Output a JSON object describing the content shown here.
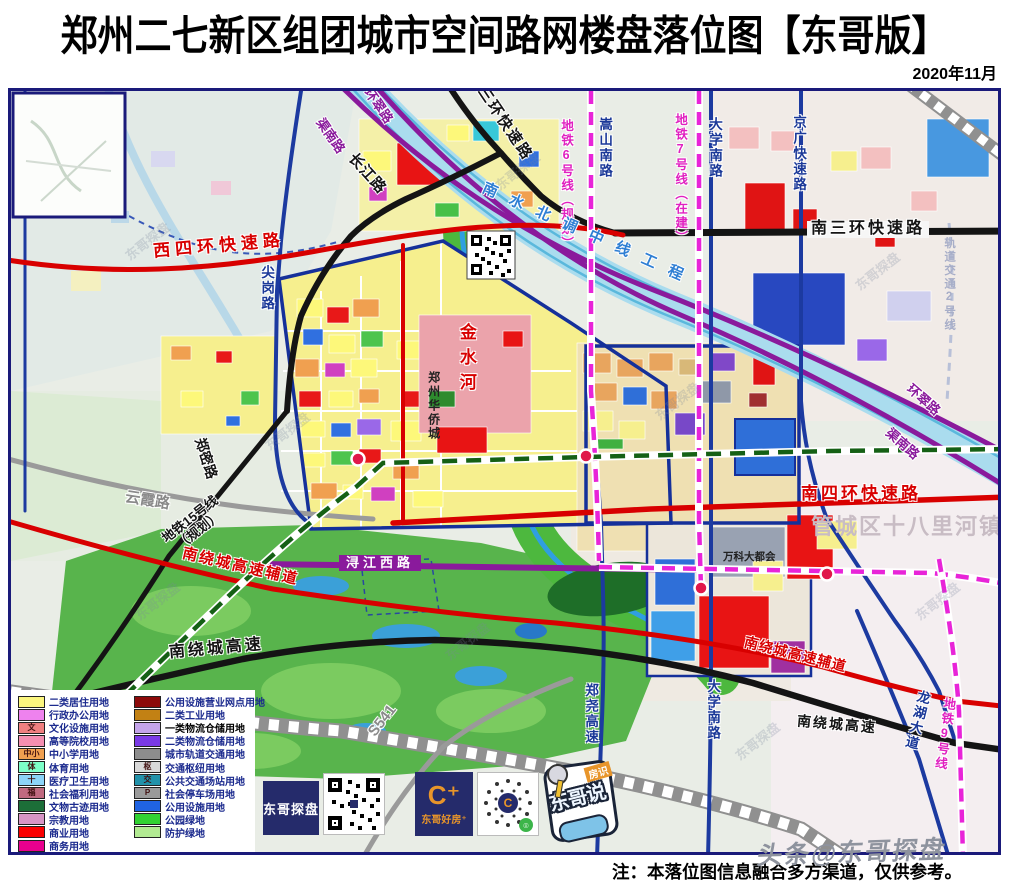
{
  "header": {
    "title": "郑州二七新区组团城市空间路网楼盘落位图【东哥版】",
    "date": "2020年11月"
  },
  "map": {
    "labels": {
      "xisihuan": "西四环快速路",
      "nansanhuan": "南三环快速路",
      "xisanhuan": "西三环快速路",
      "changjiang": "长江路",
      "huancui_top": "环翠路",
      "qunan_top": "渠南路",
      "metro6": "地铁6号线（规划）",
      "songshan": "嵩山南路",
      "metro7": "地铁7号线（在建）",
      "daxue_top": "大学南路",
      "jingguang": "京广快速路",
      "guidao2": "轨道交通2号线",
      "huancui_right": "环翠路",
      "qunan_right": "渠南路",
      "jiangang": "尖岗路",
      "yunxia": "云霞路",
      "zhengmi": "郑密路",
      "metro15": "地铁15号线\n（规划）",
      "raofu_left": "南绕城高速辅道",
      "raocheng_left": "南绕城高速",
      "xunjiang": "浔江西路",
      "nansihuan": "南四环快速路",
      "raofu_right": "南绕城高速辅道",
      "raocheng_right": "南绕城高速",
      "zhengyao": "郑尧高速",
      "daxue_bottom": "大学南路",
      "longhu": "龙湖大道",
      "metro9": "地铁9号线",
      "s541": "S541"
    },
    "landmarks": {
      "canal": "南水北调中线工程",
      "jinshui": "金水河",
      "huaqiao": "郑州华侨城",
      "wanke": "万科大都会",
      "guancheng": "管城区十八里河镇"
    },
    "watermark": "东哥探盘",
    "colors": {
      "expressway_red": "#d80000",
      "road_black": "#141414",
      "road_navy": "#1c3aa0",
      "road_purple": "#8a1a9c",
      "metro_magenta": "#e824d8",
      "metro15_green": "#156015",
      "canal_blue": "#aadcee",
      "residential_yellow": "#f6ef8e",
      "park_green": "#58b44c"
    }
  },
  "legend": {
    "left": [
      {
        "label": "二类居住用地",
        "color": "#fbf67e"
      },
      {
        "label": "行政办公用地",
        "color": "#ee82ee"
      },
      {
        "label": "文化设施用地",
        "color": "#f08080",
        "symbol": "文"
      },
      {
        "label": "高等院校用地",
        "color": "#f48fb1"
      },
      {
        "label": "中小学用地",
        "color": "#f0a050",
        "symbol": "中小"
      },
      {
        "label": "体育用地",
        "color": "#7dffc8",
        "symbol": "体"
      },
      {
        "label": "医疗卫生用地",
        "color": "#8cd4f8",
        "symbol": "十"
      },
      {
        "label": "社会福利用地",
        "color": "#c06a80",
        "symbol": "福"
      },
      {
        "label": "文物古迹用地",
        "color": "#1c6e38"
      },
      {
        "label": "宗教用地",
        "color": "#d795c5"
      },
      {
        "label": "商业用地",
        "color": "#fa0000"
      },
      {
        "label": "商务用地",
        "color": "#e8008e"
      }
    ],
    "right": [
      {
        "label": "公用设施营业网点用地",
        "color": "#8c0a0a"
      },
      {
        "label": "二类工业用地",
        "color": "#c28114"
      },
      {
        "label": "一类物流仓储用地",
        "color": "#c4a4ea"
      },
      {
        "label": "二类物流仓储用地",
        "color": "#7a3ae6"
      },
      {
        "label": "城市轨道交通用地",
        "color": "#8d8d8d"
      },
      {
        "label": "交通枢纽用地",
        "color": "#d9d9d9",
        "symbol": "枢"
      },
      {
        "label": "公共交通场站用地",
        "color": "#2292aa",
        "symbol": "交"
      },
      {
        "label": "社会停车场用地",
        "color": "#9a9a9a",
        "symbol": "P"
      },
      {
        "label": "公用设施用地",
        "color": "#2063e2"
      },
      {
        "label": "公园绿地",
        "color": "#32d232"
      },
      {
        "label": "防护绿地",
        "color": "#b2ea92"
      }
    ]
  },
  "logos": {
    "tanpan": "东哥探盘",
    "haofang": "东哥好房⁺",
    "badge_top": "房识",
    "badge_main": "东哥说"
  },
  "footer": {
    "note": "注：本落位图信息融合多方渠道，仅供参考。",
    "watermark": "头条@东哥探盘"
  }
}
